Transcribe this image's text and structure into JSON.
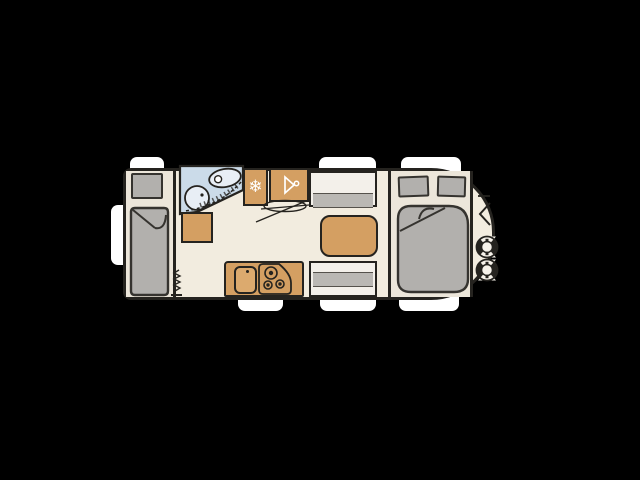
{
  "meta": {
    "description": "Caravan (travel trailer) top-view floor plan drawing on a black background",
    "canvas": {
      "width": 640,
      "height": 480
    },
    "no_visible_text": true
  },
  "palette": {
    "bg": "#000000",
    "outline": "#25231f",
    "body-fill": "#f2ecdf",
    "base-fill": "#ece6da",
    "tan": "#d49f62",
    "tan-light": "#dcaa6e",
    "gray": "#b2b0ad",
    "gray-band": "#bab8b4",
    "blue": "#cbdbe9",
    "blue-light": "#e8eef5",
    "white": "#ffffff",
    "bench": "#f3f0ea"
  },
  "icons": {
    "fridge_glyph": "❄",
    "wardrobe_icon": "clothes-hanger",
    "heater_icon": "zigzag-heater-symbol",
    "gas_bottles": 2
  },
  "floorplan": {
    "orientation": "rear at left (flat end), drawbar front at right (rounded end)",
    "windows": {
      "top": 3,
      "bottom": 3,
      "rear": 1
    },
    "rooms": [
      {
        "name": "rear-single-bed",
        "items": [
          "pillow",
          "mattress-with-folded-corner"
        ]
      },
      {
        "name": "washroom",
        "items": [
          "toilet",
          "washbasin",
          "shower-curtain"
        ]
      },
      {
        "name": "galley",
        "items": [
          "fridge-freezer",
          "wardrobe",
          "tv-bracket",
          "heater",
          "kitchen-counter",
          "sink",
          "three-burner-hob"
        ]
      },
      {
        "name": "dinette",
        "items": [
          "bench-seat-top",
          "bench-seat-bottom",
          "table"
        ]
      },
      {
        "name": "front-bedroom",
        "items": [
          "pillow-left",
          "pillow-right",
          "double-mattress"
        ]
      },
      {
        "name": "gas-locker",
        "items": [
          "gas-bottle-1",
          "gas-bottle-2",
          "locker-chevron"
        ]
      }
    ]
  }
}
